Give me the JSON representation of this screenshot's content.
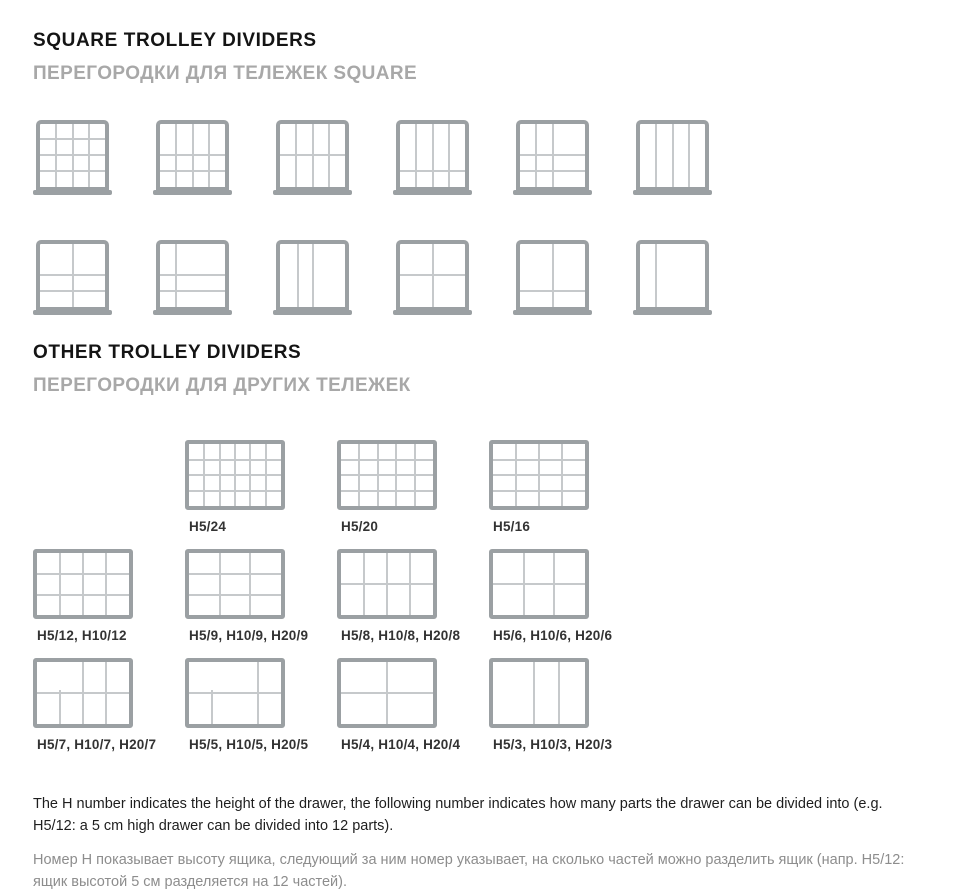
{
  "colors": {
    "tray_border": "#9ba0a3",
    "inner_line": "#c6c9cb",
    "title_color": "#141414",
    "subtitle_color": "#a8a8a8",
    "label_color": "#333333",
    "note_en_color": "#1e1e1e",
    "note_ru_color": "#8d8d8d",
    "page_bg": "#ffffff"
  },
  "section_square": {
    "title": "SQUARE TROLLEY DIVIDERS",
    "subtitle": "ПЕРЕГОРОДКИ ДЛЯ ТЕЛЕЖЕК SQUARE",
    "rows": [
      [
        {
          "parts": 16,
          "v": [
            25,
            50,
            75
          ],
          "h": [
            25,
            50,
            75
          ]
        },
        {
          "parts": 12,
          "v": [
            25,
            50,
            75
          ],
          "h": [
            50,
            75
          ]
        },
        {
          "parts": 8,
          "v": [
            25,
            50,
            75
          ],
          "h": [
            50
          ]
        },
        {
          "parts": 8,
          "v": [
            25,
            50,
            75
          ],
          "h": [
            75
          ]
        },
        {
          "parts": 9,
          "v": [
            25,
            50
          ],
          "h": [
            50,
            75
          ]
        },
        {
          "parts": 4,
          "v": [
            25,
            50,
            75
          ],
          "h": []
        }
      ],
      [
        {
          "parts": 6,
          "v": [
            50
          ],
          "h": [
            50,
            75
          ]
        },
        {
          "parts": 6,
          "v": [
            25
          ],
          "h": [
            50,
            75
          ]
        },
        {
          "parts": 3,
          "v": [
            27,
            50
          ],
          "h": []
        },
        {
          "parts": 4,
          "v": [
            50
          ],
          "h": [
            50
          ]
        },
        {
          "parts": 4,
          "v": [
            50
          ],
          "h": [
            75
          ]
        },
        {
          "parts": 2,
          "v": [
            25
          ],
          "h": []
        }
      ]
    ]
  },
  "section_other": {
    "title": "OTHER TROLLEY DIVIDERS",
    "subtitle": "ПЕРЕГОРОДКИ ДЛЯ ДРУГИХ ТЕЛЕЖЕК",
    "rows": [
      {
        "offset": 1,
        "cells": [
          {
            "label": "H5/24",
            "parts": 24,
            "v": [
              16.7,
              33.3,
              50,
              66.7,
              83.3
            ],
            "h": [
              25,
              50,
              75
            ]
          },
          {
            "label": "H5/20",
            "parts": 20,
            "v": [
              20,
              40,
              60,
              80
            ],
            "h": [
              25,
              50,
              75
            ]
          },
          {
            "label": "H5/16",
            "parts": 16,
            "v": [
              25,
              50,
              75
            ],
            "h": [
              25,
              50,
              75
            ]
          }
        ]
      },
      {
        "offset": 0,
        "cells": [
          {
            "label": "H5/12, H10/12",
            "parts": 12,
            "v": [
              25,
              50,
              75
            ],
            "h": [
              33.4,
              66.7
            ]
          },
          {
            "label": "H5/9, H10/9, H20/9",
            "parts": 9,
            "v": [
              33.4,
              66.7
            ],
            "h": [
              33.4,
              66.7
            ]
          },
          {
            "label": "H5/8, H10/8, H20/8",
            "parts": 8,
            "v": [
              25,
              50,
              75
            ],
            "h": [
              50
            ]
          },
          {
            "label": "H5/6, H10/6, H20/6",
            "parts": 6,
            "v": [
              33.4,
              66.7
            ],
            "h": [
              50
            ]
          }
        ]
      },
      {
        "offset": 0,
        "cells": [
          {
            "label": "H5/7, H10/7, H20/7",
            "parts": 7,
            "v": [
              {
                "x": 50
              },
              {
                "x": 75
              },
              {
                "x": 25,
                "y1": 44,
                "y2": 100
              }
            ],
            "h": [
              50
            ]
          },
          {
            "label": "H5/5, H10/5, H20/5",
            "parts": 5,
            "v": [
              {
                "x": 75
              },
              {
                "x": 25,
                "y1": 44,
                "y2": 100
              }
            ],
            "h": [
              50
            ]
          },
          {
            "label": "H5/4, H10/4, H20/4",
            "parts": 4,
            "v": [
              50
            ],
            "h": [
              50
            ]
          },
          {
            "label": "H5/3, H10/3, H20/3",
            "parts": 3,
            "v": [
              45,
              72
            ],
            "h": []
          }
        ]
      }
    ]
  },
  "notes": {
    "en": "The H number indicates the height of the drawer, the following number indicates how many parts the drawer can be divided into (e.g. H5/12: a 5 cm high drawer can be divided into 12 parts).",
    "ru": "Номер H показывает высоту ящика, следующий за ним номер указывает, на сколько частей можно разделить ящик (напр. H5/12: ящик высотой 5 см разделяется на 12 частей)."
  }
}
